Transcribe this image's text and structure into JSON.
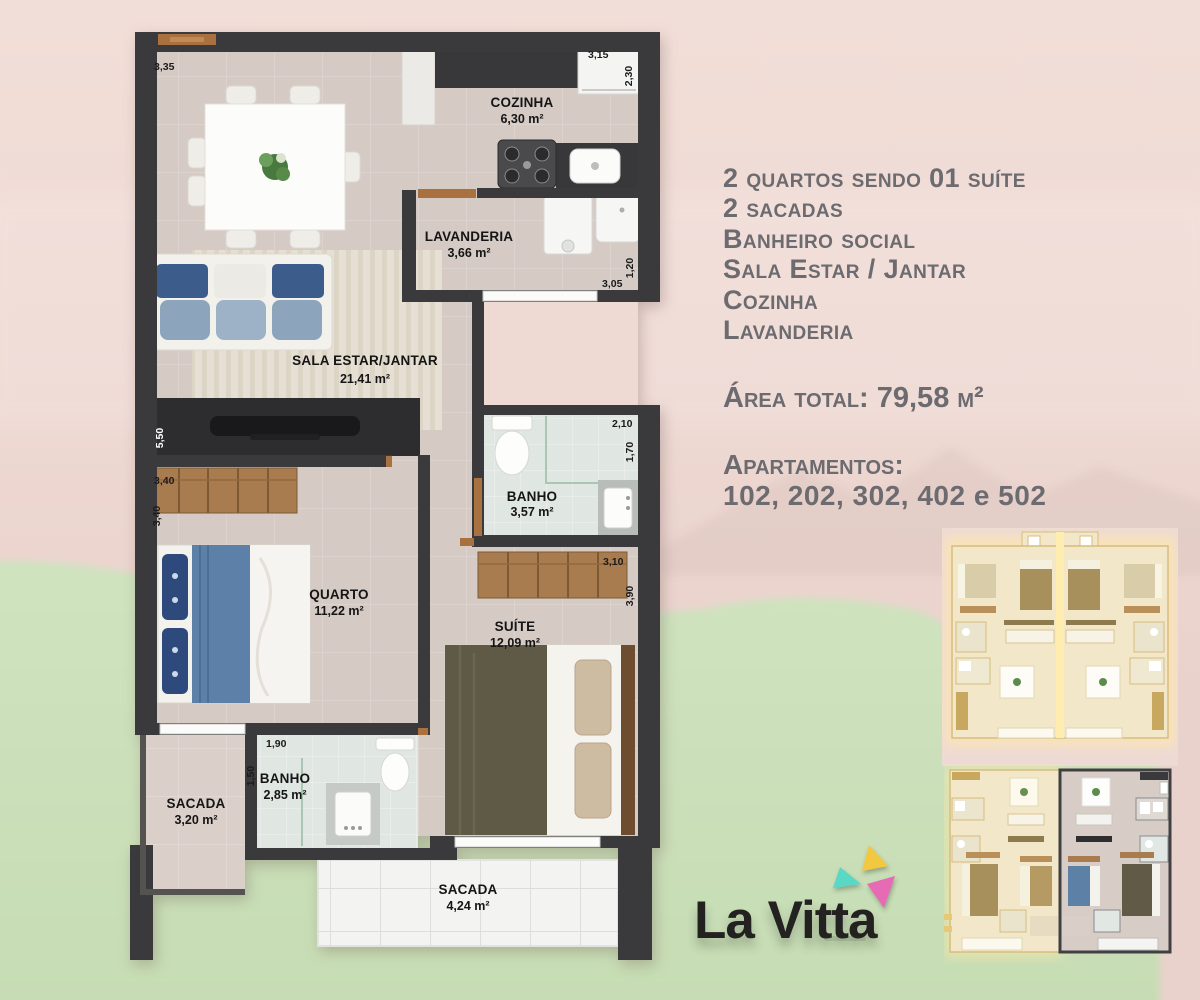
{
  "plan": {
    "rooms": [
      {
        "id": "cozinha",
        "name": "COZINHA",
        "area": "6,30 m²"
      },
      {
        "id": "lavanderia",
        "name": "LAVANDERIA",
        "area": "3,66 m²"
      },
      {
        "id": "sala",
        "name": "SALA ESTAR/JANTAR",
        "area": "21,41 m²"
      },
      {
        "id": "banho-social",
        "name": "BANHO",
        "area": "3,57 m²"
      },
      {
        "id": "quarto",
        "name": "QUARTO",
        "area": "11,22 m²"
      },
      {
        "id": "suite",
        "name": "SUÍTE",
        "area": "12,09 m²"
      },
      {
        "id": "banho-suite",
        "name": "BANHO",
        "area": "2,85 m²"
      },
      {
        "id": "sacada-1",
        "name": "SACADA",
        "area": "3,20 m²"
      },
      {
        "id": "sacada-2",
        "name": "SACADA",
        "area": "4,24 m²"
      }
    ],
    "dimensions": {
      "top_left": "3,35",
      "top_right": "3,15",
      "kitchen_depth": "2,30",
      "lav_width": "3,05",
      "lav_depth": "1,20",
      "sala_height": "5,50",
      "quarto_width": "3,40",
      "quarto_depth": "3,40",
      "banho_width": "2,10",
      "banho_depth": "1,70",
      "suite_width": "3,10",
      "suite_depth": "3,90",
      "banho2_width": "1,90",
      "banho2_depth": "1,50"
    }
  },
  "info": {
    "features": [
      "2 quartos sendo 01 suíte",
      "2 sacadas",
      "Banheiro social",
      "Sala Estar / Jantar",
      "Cozinha",
      "Lavanderia"
    ],
    "area_total": "Área total: 79,58 m²",
    "apartments_label": "Apartamentos:",
    "apartments_numbers": "102, 202, 302, 402 e 502"
  },
  "logo": {
    "name": "La Vitta"
  },
  "colors": {
    "background_pink": "#eed9d3",
    "background_green": "#cbdfba",
    "wall": "#3a393b",
    "floor": "#d5cac4",
    "bath_floor": "#e0e6e2",
    "wood": "#a87c4f",
    "accent_teal": "#5ad8c6",
    "accent_yellow": "#f2c83f",
    "accent_pink": "#e66bb4"
  }
}
